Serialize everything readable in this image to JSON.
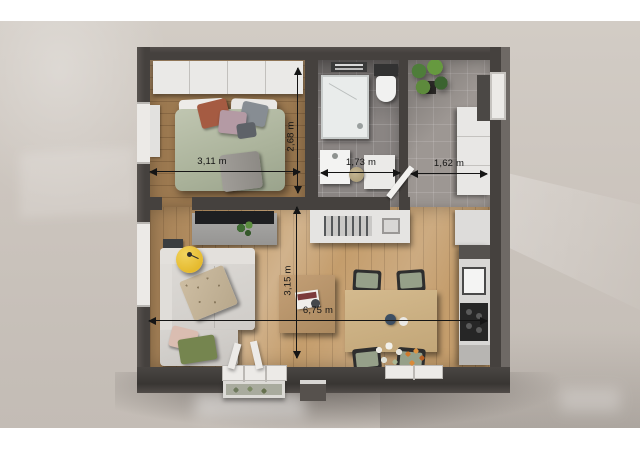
{
  "scene": {
    "description": "3D rendered top-down floor plan of a one-bedroom apartment",
    "backdrop_color": "#cbc4bd",
    "wall_color": "#45413e",
    "accent_colors": {
      "bedroom_floor": "#9c7950",
      "living_floor": "#c49d6c",
      "bathroom_tile": "#8a8583",
      "hall_tile": "#9d9793",
      "sofa": "#d5d2ce",
      "bed_duvet": "#b4bba5",
      "lamp_yellow": "#e9c43b",
      "chair_seat": "#96a089",
      "plant_green": "#5d8a3c"
    }
  },
  "dimensions": [
    {
      "id": "bedroom-width",
      "label": "3,11 m",
      "orientation": "horizontal"
    },
    {
      "id": "bedroom-depth",
      "label": "2,68 m",
      "orientation": "vertical"
    },
    {
      "id": "bathroom-width",
      "label": "1,73 m",
      "orientation": "horizontal"
    },
    {
      "id": "entry-width",
      "label": "1,62 m",
      "orientation": "horizontal"
    },
    {
      "id": "living-depth",
      "label": "3,15 m",
      "orientation": "vertical"
    },
    {
      "id": "apartment-width",
      "label": "6,75 m",
      "orientation": "horizontal"
    }
  ]
}
